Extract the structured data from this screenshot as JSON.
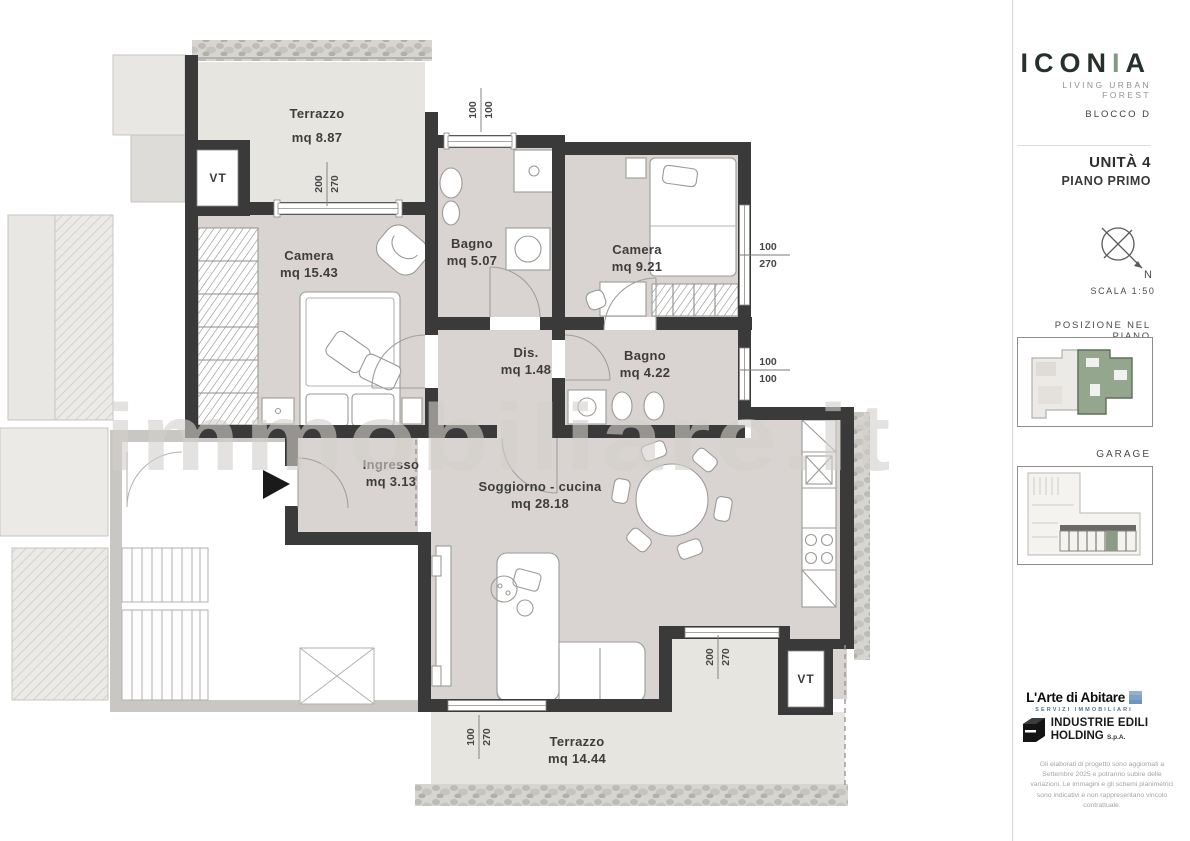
{
  "sidebar": {
    "brand": {
      "name_pre": "ICON",
      "name_green": "I",
      "name_post": "A",
      "tagline": "LIVING URBAN FOREST",
      "block": "BLOCCO D"
    },
    "unit": {
      "name": "UNITÀ 4",
      "floor": "PIANO PRIMO"
    },
    "compass": {
      "north": "N",
      "scale": "SCALA 1:50"
    },
    "position": {
      "heading": "POSIZIONE NEL PIANO"
    },
    "garage": {
      "heading": "GARAGE"
    },
    "agency": {
      "name": "L'Arte di Abitare",
      "tagline": "SERVIZI IMMOBILIARI"
    },
    "builder": {
      "line1": "INDUSTRIE EDILI",
      "line2": "HOLDING",
      "suffix": "S.p.A."
    },
    "disclaimer": "Gli elaborati di progetto sono aggiornati a Settembre 2025 e potranno subire delle variazioni. Le immagini e gli schemi planimetrici sono indicativi e non rappresentano vincolo contrattuale."
  },
  "plan": {
    "watermark": "immobiliare.it",
    "vt": "VT",
    "rooms": [
      {
        "name": "Terrazzo",
        "area": "mq 8.87"
      },
      {
        "name": "Camera",
        "area": "mq 15.43"
      },
      {
        "name": "Bagno",
        "area": "mq 5.07"
      },
      {
        "name": "Camera",
        "area": "mq 9.21"
      },
      {
        "name": "Dis.",
        "area": "mq 1.48"
      },
      {
        "name": "Bagno",
        "area": "mq 4.22"
      },
      {
        "name": "Ingresso",
        "area": "mq 3.13"
      },
      {
        "name": "Soggiorno - cucina",
        "area": "mq 28.18"
      },
      {
        "name": "Terrazzo",
        "area": "mq 14.44"
      }
    ],
    "dims": [
      {
        "a": "100",
        "b": "100"
      },
      {
        "a": "200",
        "b": "270"
      },
      {
        "a": "100",
        "b": "270"
      },
      {
        "a": "100",
        "b": "100"
      },
      {
        "a": "200",
        "b": "270"
      },
      {
        "a": "100",
        "b": "270"
      }
    ],
    "colors": {
      "wall": "#3a3a3a",
      "floor": "#d9d4d1",
      "terrace": "#e6e5df",
      "highlight_green": "#93a48e",
      "common": "#c9c7c4"
    }
  }
}
